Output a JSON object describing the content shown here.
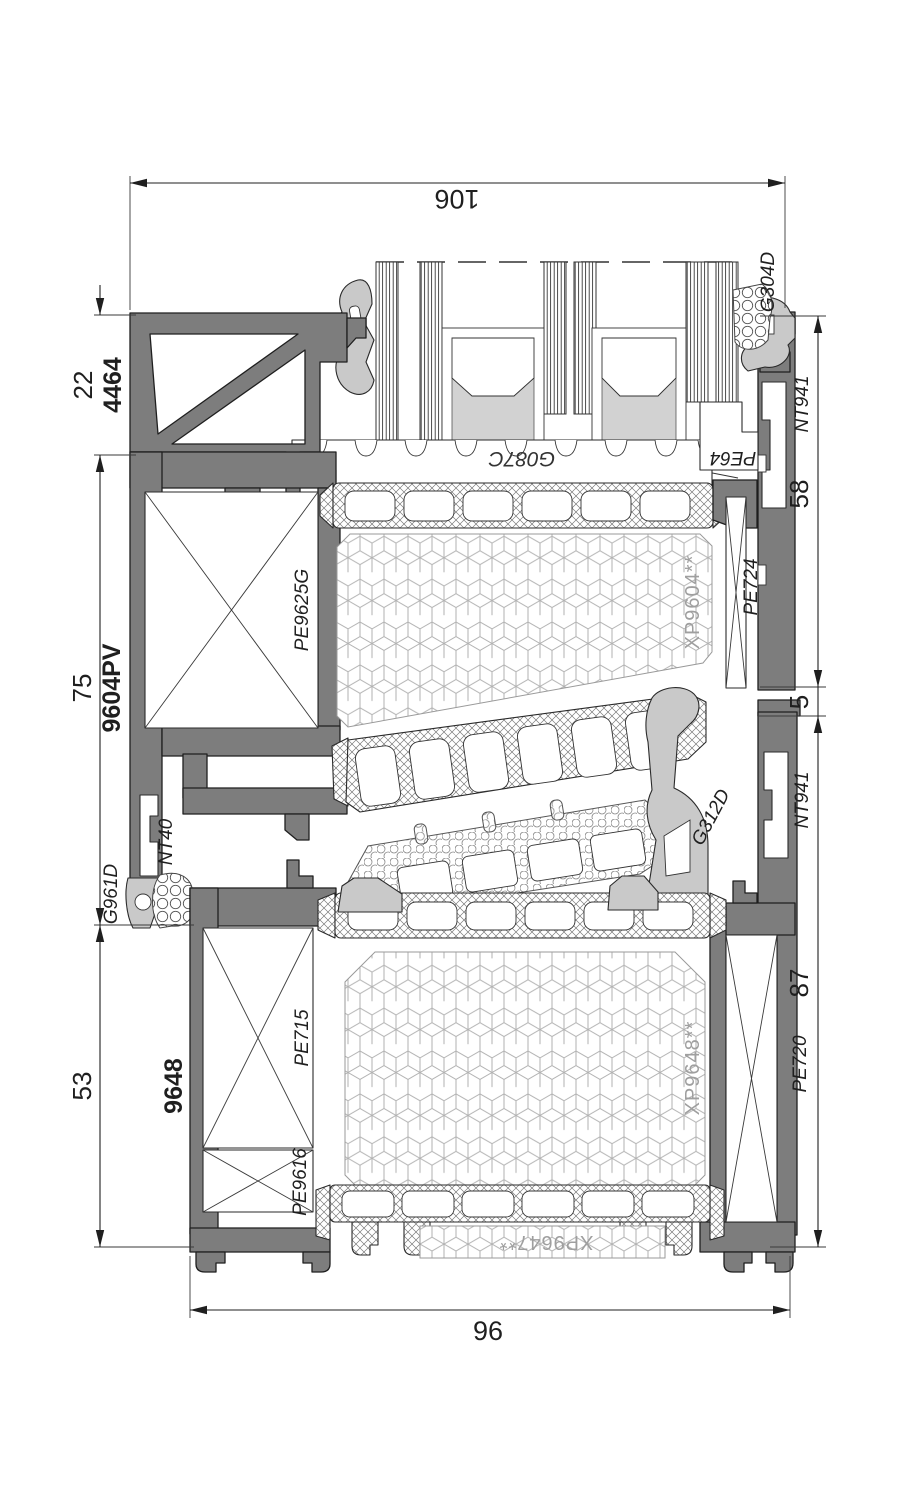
{
  "dims": {
    "top": "106",
    "bottom": "96",
    "left_top": "22",
    "left_mid": "75",
    "left_bottom": "53",
    "right_top": "58",
    "right_mid": "5",
    "right_bottom": "87"
  },
  "profiles": {
    "top_cover": "4464",
    "upper_frame": "9604PV",
    "lower_frame": "9648"
  },
  "parts": {
    "g304d": "G304D",
    "nt941_top": "NT941",
    "pe64": "PE64",
    "g087c": "G087C",
    "pe9625g": "PE9625G",
    "xp9604": "XP9604**",
    "pe724": "PE724",
    "nt40": "NT40",
    "g961d": "G961D",
    "g312d": "G312D",
    "nt941_bottom": "NT941",
    "pe715": "PE715",
    "xp9648": "XP9648**",
    "pe720": "PE720",
    "pe9616": "PE9616",
    "xp9647": "XP9647**"
  },
  "colors": {
    "aluminum": "#7d7d7d",
    "gasket": "#c9c9c9",
    "outline": "#1f1f1f",
    "foam_label": "#9f9f9f",
    "glass_fill": "#d2d2d2"
  }
}
